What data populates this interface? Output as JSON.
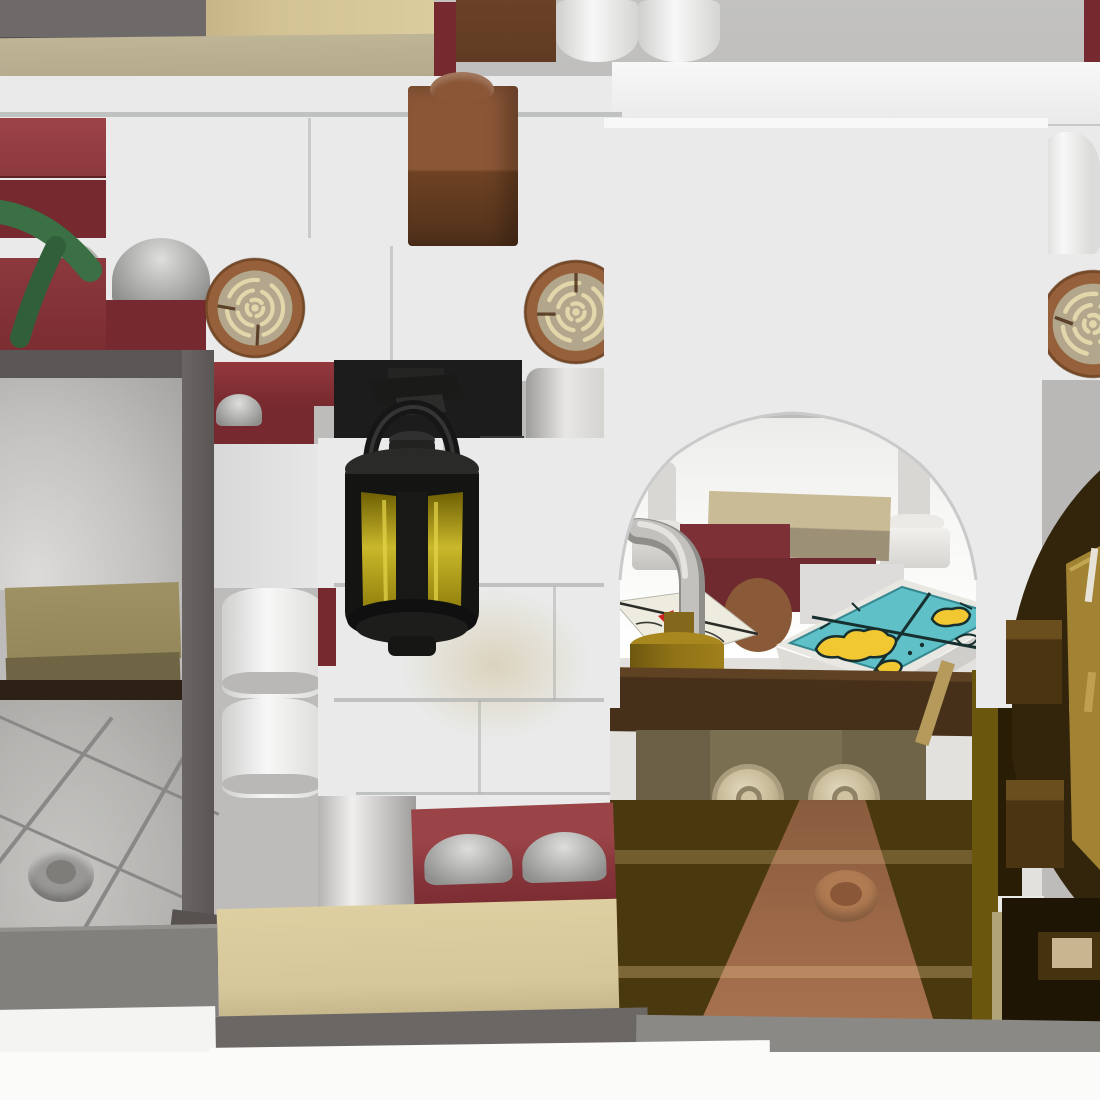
{
  "meta": {
    "description": "3D CAD-style render of a LEGO building model: white brick walls with dark red accents, log-end bricks, hanging black lantern with yellow glass, arched doorway revealing an interior table with island map tile, letter tile, gold jug, and a wooden wheel at the right edge.",
    "render_kind": "lego-model-render",
    "text_content": []
  },
  "palette": {
    "bg_gray": "#bdbcba",
    "white_wall": "#e9eae9",
    "white_hi": "#f7f8f7",
    "white_lo": "#cfd0ce",
    "seam": "#aeb0af",
    "dark_gray_block": "#6e6a69",
    "frame_gray": "#5b5656",
    "panel_gray": "#c2c1bf",
    "tile_floor_gray": "#b5b4b1",
    "platform_gray": "#82807d",
    "strip_dark_gray": "#6b6765",
    "strip_mid_gray": "#8b8986",
    "tan_block": "#d2c294",
    "khaki_band": "#b4aa8c",
    "tan_bottom": "#d5c79a",
    "tan_platform": "#948759",
    "tan_interior": "#cabb97",
    "tan_interior_front": "#9c9076",
    "under_panel_tan": "#7b6f52",
    "volute_tan": "#c6b996",
    "dark_red": "#8c393d",
    "dark_red_deep": "#76292e",
    "dark_red_bright": "#9a4448",
    "brown_block": "#5f3a22",
    "brown_stud_top": "#8a5636",
    "log_ring": "#96613a",
    "log_face": "#b2a68d",
    "log_grain": "#e2d6ab",
    "leaf_green": "#3a7044",
    "leaf_green_dark": "#315f3a",
    "silver": "#d8d8d6",
    "silver_dark": "#8e8e8c",
    "gray_cyl": "#999b9b",
    "black_panel": "#1d1c1c",
    "lantern_black": "#161616",
    "glass_yellow": "#c9b82a",
    "glass_yellow_dark": "#6e5f04",
    "back_wall": "#f7f7f5",
    "pillar_gray": "#d8d7d4",
    "red_interior": "#7d3035",
    "brown_disc": "#8a5a38",
    "gold": "#8f7216",
    "gold_light": "#a8871f",
    "teal": "#5fc0c8",
    "map_yellow": "#f2c832",
    "map_line": "#17302f",
    "map_rim": "#e8e7e2",
    "table_brown": "#46301a",
    "floor_brown": "#9c6848",
    "floor_olive": "#4a390e",
    "gold_strip": "#6b560e",
    "wheel_brown": "#33250c",
    "wheel_inner": "#241a06",
    "wheel_panel": "#a28233",
    "ledge_brown": "#4a3411",
    "ledge_top": "#6b4e1e",
    "dark_corner": "#1f1504",
    "notch_tan": "#c9b691",
    "white_fg": "#fbfbfa"
  },
  "parts": [
    "white-brick-wall",
    "dark-red-brick",
    "log-end-brick",
    "round-white-brick",
    "ribbed-gray-cylinder",
    "reddish-brown-stud-brick",
    "tan-brick",
    "khaki-ledge",
    "green-leaf-element",
    "black-lantern",
    "lantern-yellow-glass",
    "arched-opening",
    "interior-back-wall",
    "candle-pillar",
    "letter-tile",
    "gold-jug-with-hose",
    "island-map-tile",
    "dark-brown-table",
    "scroll-volute",
    "interior-floor-path",
    "round-brown-tile",
    "wooden-wheel",
    "door-frame",
    "gray-tile-floor",
    "hollow-stud",
    "inverted-gray-dish",
    "tan-base-band",
    "silver-column",
    "gray-base-strip",
    "white-foreground"
  ]
}
